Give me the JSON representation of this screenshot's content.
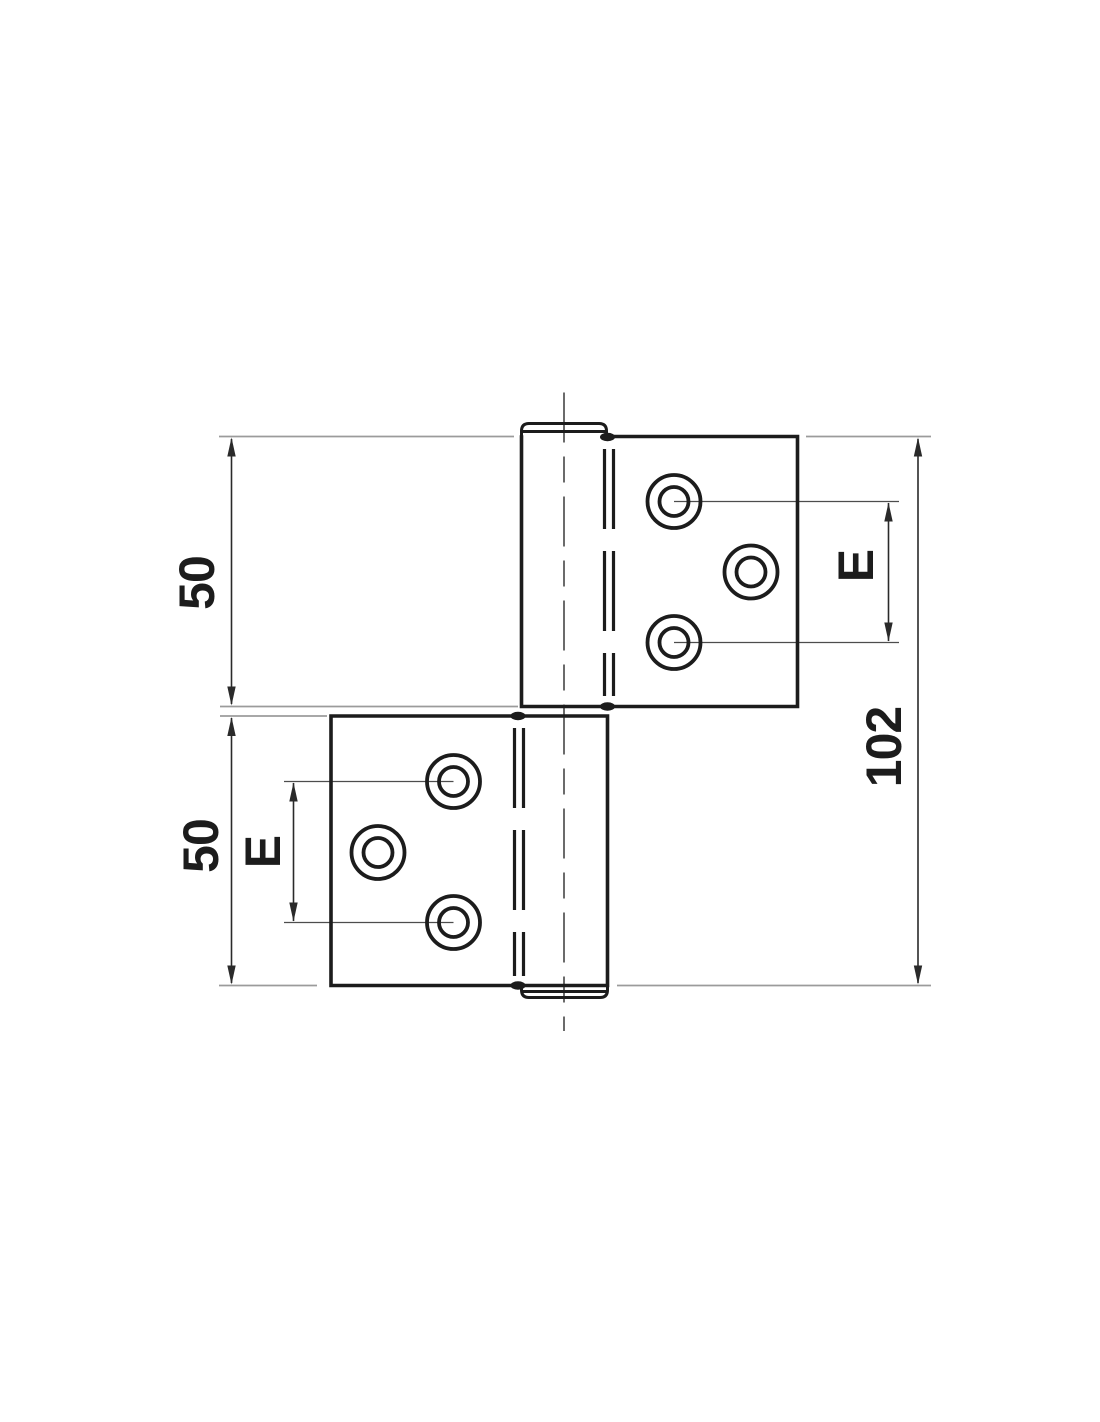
{
  "drawing": {
    "title": "hinge-technical-drawing",
    "background_color": "#ffffff",
    "outline_color": "#1c1c1c",
    "dimension_color": "#2a2a2a",
    "extension_line_color": "#9b9b9b",
    "leader_line_color": "#4d4d4d",
    "dimensions": {
      "upper_leaf_height": {
        "label": "50"
      },
      "lower_leaf_height": {
        "label": "50"
      },
      "total_height": {
        "label": "102"
      },
      "upper_hole_spacing": {
        "label": "E"
      },
      "lower_hole_spacing": {
        "label": "E"
      }
    }
  }
}
